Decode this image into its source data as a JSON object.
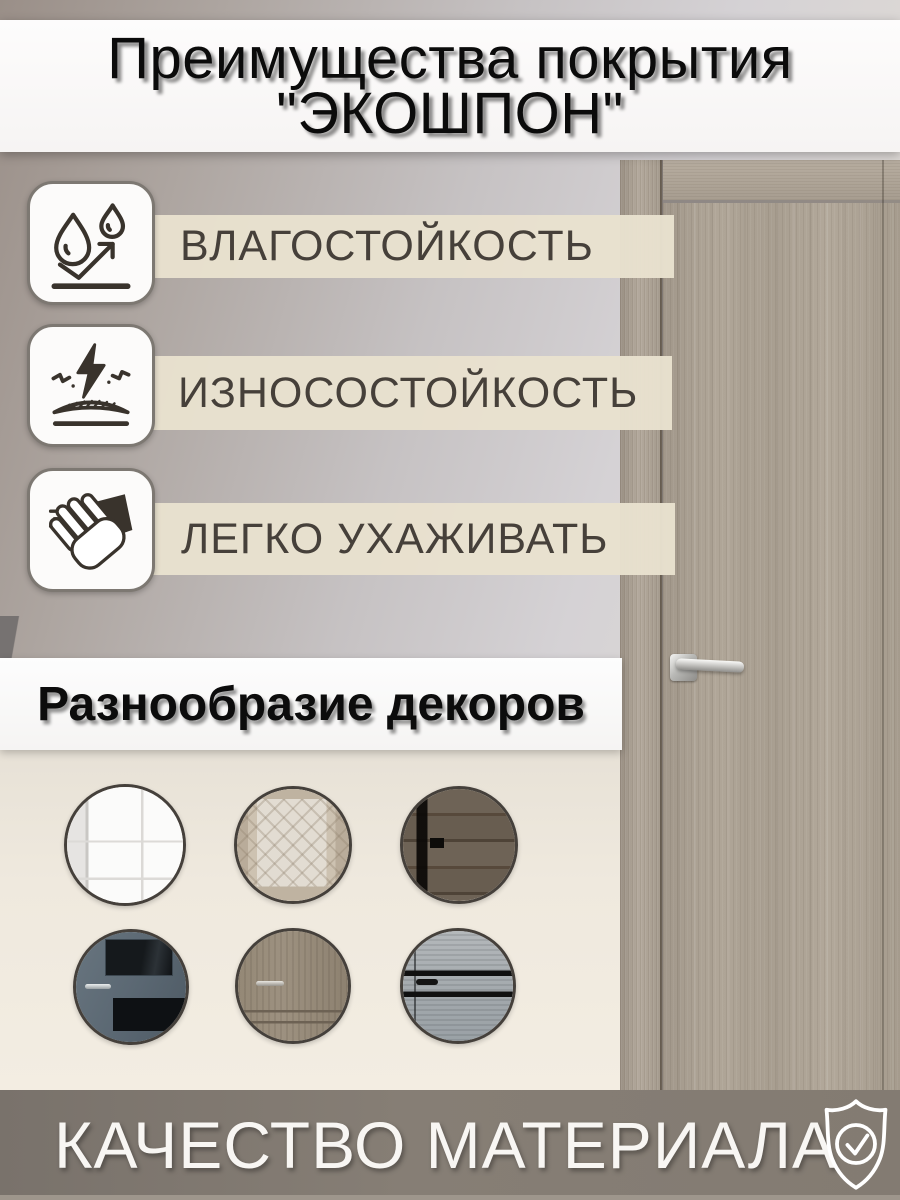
{
  "header": {
    "title_line1": "Преимущества покрытия",
    "title_line2": "\"ЭКОШПОН\""
  },
  "features": [
    {
      "icon": "water-drops-icon",
      "label": "ВЛАГОСТОЙКОСТЬ"
    },
    {
      "icon": "impact-resistance-icon",
      "label": "ИЗНОСОСТОЙКОСТЬ"
    },
    {
      "icon": "hand-wipe-icon",
      "label": "ЛЕГКО УХАЖИВАТЬ"
    }
  ],
  "decors": {
    "title": "Разнообразие декоров",
    "items": [
      {
        "name": "white-classic-door"
      },
      {
        "name": "oak-door-with-patterned-glass"
      },
      {
        "name": "dark-rustic-wood-door"
      },
      {
        "name": "blue-gray-door-with-dark-glass"
      },
      {
        "name": "gray-wood-classic-door"
      },
      {
        "name": "light-gray-wood-door-black-inserts"
      }
    ]
  },
  "footer": {
    "label": "КАЧЕСТВО МАТЕРИАЛА",
    "icon": "shield-check-icon"
  },
  "colors": {
    "strip_beige": "#e8e1ce",
    "banner_white": "#fbfafa",
    "footer_gray": "#837b72",
    "text_dark": "#46403a",
    "door_wood": "#aca295"
  }
}
